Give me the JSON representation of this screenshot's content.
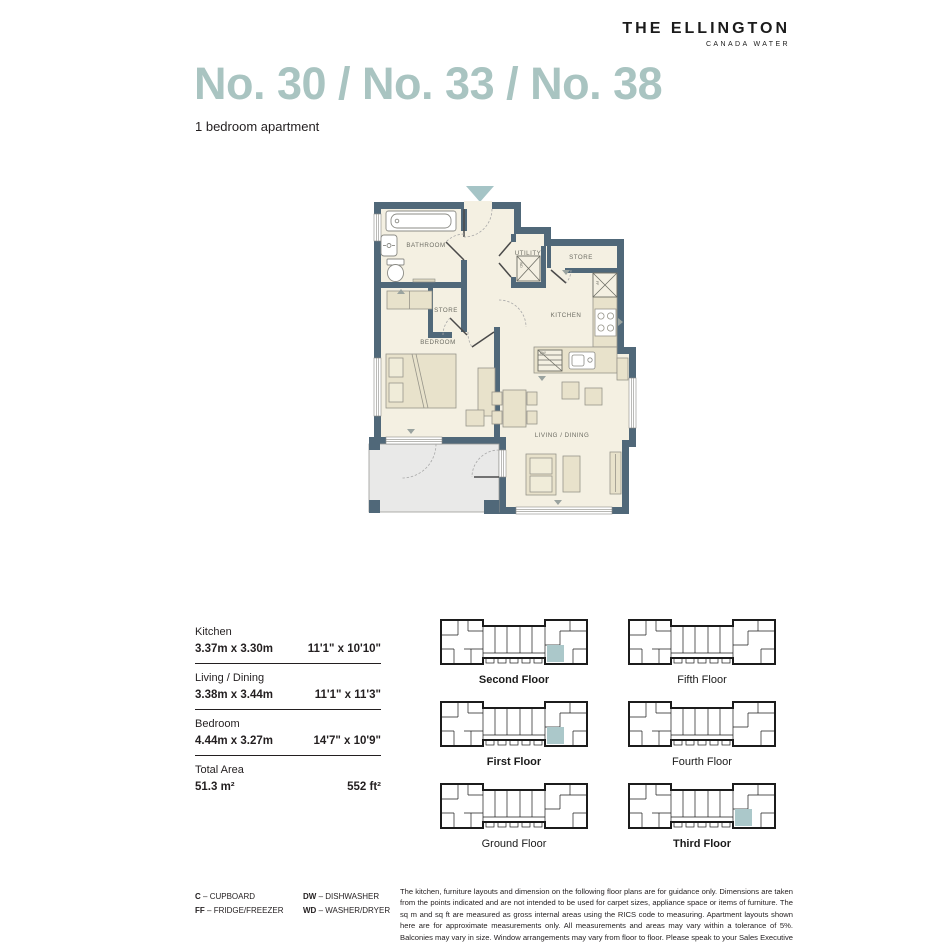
{
  "brand": {
    "name": "THE ELLINGTON",
    "location": "CANADA WATER"
  },
  "title": "No. 30 / No. 33 / No. 38",
  "subtitle": "1 bedroom apartment",
  "plan": {
    "rooms": {
      "bathroom": "BATHROOM",
      "store_mid": "STORE",
      "utility": "UTILITY",
      "store_top": "STORE",
      "kitchen": "KITCHEN",
      "bedroom": "BEDROOM",
      "living": "LIVING / DINING"
    },
    "appliances": {
      "wd": "WD",
      "ff": "FF",
      "dw": "DW"
    }
  },
  "dimensions": {
    "rows": [
      {
        "room": "Kitchen",
        "metric": "3.37m x 3.30m",
        "imperial": "11'1\" x 10'10\""
      },
      {
        "room": "Living / Dining",
        "metric": "3.38m x 3.44m",
        "imperial": "11'1\" x 11'3\""
      },
      {
        "room": "Bedroom",
        "metric": "4.44m x 3.27m",
        "imperial": "14'7\" x 10'9\""
      },
      {
        "room": "Total Area",
        "metric": "51.3 m²",
        "imperial": "552 ft²"
      }
    ]
  },
  "floor_keys": [
    {
      "label": "Second Floor",
      "highlighted": true
    },
    {
      "label": "Fifth Floor",
      "highlighted": false
    },
    {
      "label": "First Floor",
      "highlighted": true
    },
    {
      "label": "Fourth Floor",
      "highlighted": false
    },
    {
      "label": "Ground Floor",
      "highlighted": false
    },
    {
      "label": "Third Floor",
      "highlighted": true
    }
  ],
  "legend": [
    {
      "abbr": "C",
      "desc": "– CUPBOARD"
    },
    {
      "abbr": "FF",
      "desc": "– FRIDGE/FREEZER"
    },
    {
      "abbr": "DW",
      "desc": "– DISHWASHER"
    },
    {
      "abbr": "WD",
      "desc": "– WASHER/DRYER"
    }
  ],
  "disclaimer": "The kitchen, furniture layouts and dimension on the following floor plans are for guidance only. Dimensions are taken from the points indicated and are not intended to be used for carpet sizes, appliance space or items of furniture.  The sq m and sq ft are measured as gross internal areas using the RICS code to measuring. Apartment layouts shown here are for approximate measurements only.  All measurements and areas may vary within a tolerance of 5%. Balconies may vary in size. Window arrangements may vary from floor to floor.  Please speak to your Sales Executive for details.",
  "colors": {
    "accent_teal": "#a9c4c1",
    "wall": "#506879",
    "floor": "#f4f0e2",
    "furniture": "#e8e2cb",
    "balcony": "#e9e9e8"
  }
}
